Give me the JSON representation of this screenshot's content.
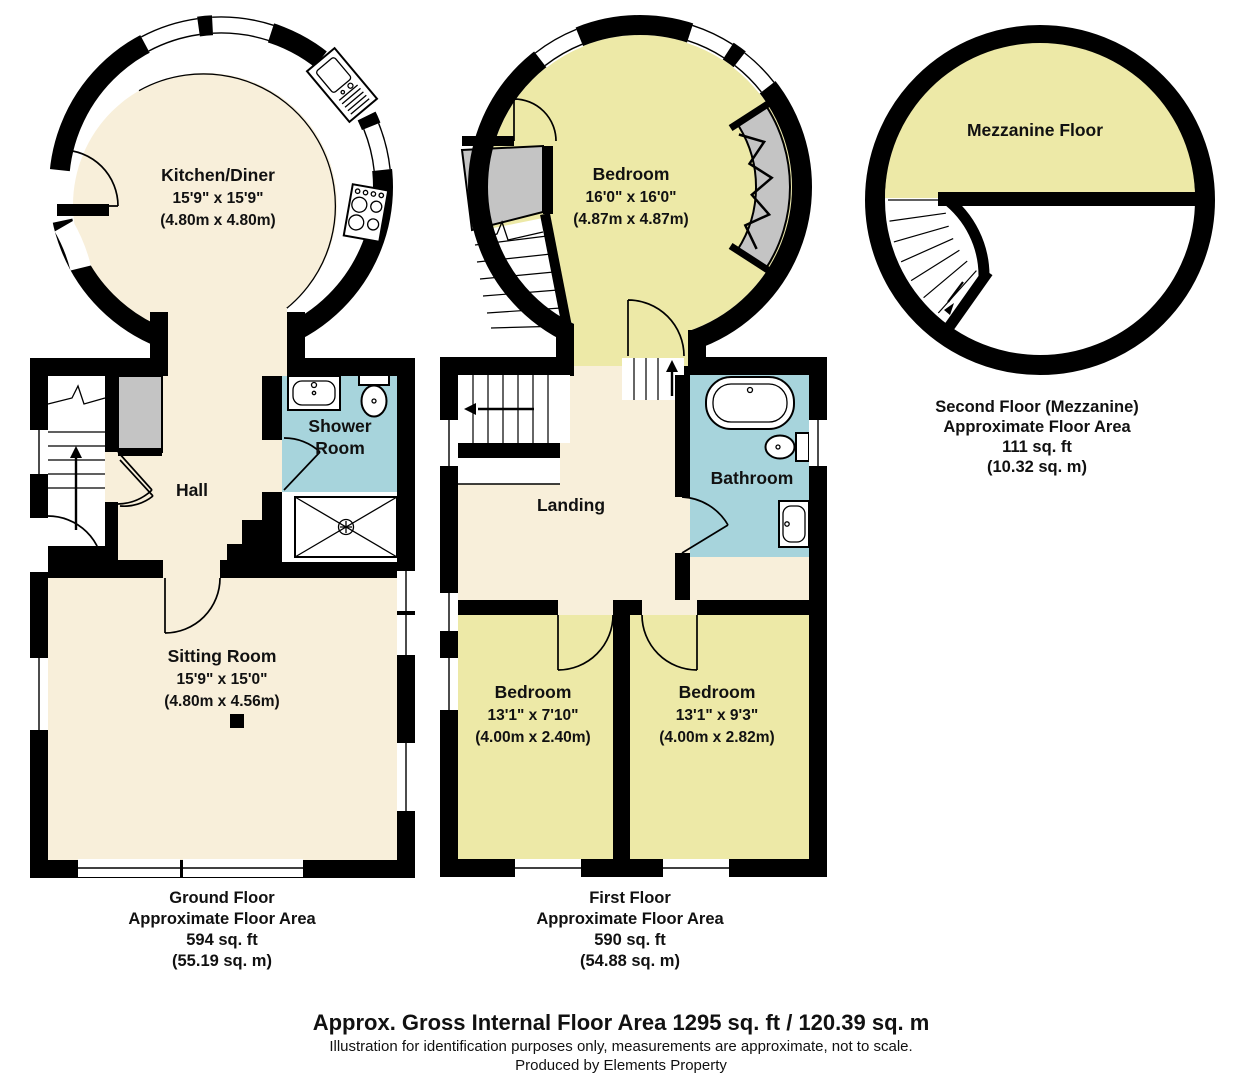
{
  "colors": {
    "room_cream": "#F8EFDA",
    "room_yellow": "#EDE9A7",
    "room_blue": "#A7D4DC",
    "cupboard_gray": "#C4C4C4",
    "wall_black": "#000000"
  },
  "ground_floor": {
    "kitchen": {
      "name": "Kitchen/Diner",
      "dims_imperial": "15'9\" x 15'9\"",
      "dims_metric": "(4.80m x 4.80m)"
    },
    "hall": {
      "name": "Hall"
    },
    "shower_room": {
      "name_line1": "Shower",
      "name_line2": "Room"
    },
    "sitting_room": {
      "name": "Sitting Room",
      "dims_imperial": "15'9\" x 15'0\"",
      "dims_metric": "(4.80m x 4.56m)"
    },
    "caption": {
      "line1": "Ground Floor",
      "line2": "Approximate Floor Area",
      "line3": "594 sq. ft",
      "line4": "(55.19 sq. m)"
    }
  },
  "first_floor": {
    "bedroom_main": {
      "name": "Bedroom",
      "dims_imperial": "16'0\" x 16'0\"",
      "dims_metric": "(4.87m x 4.87m)"
    },
    "landing": {
      "name": "Landing"
    },
    "bathroom": {
      "name": "Bathroom"
    },
    "bedroom_left": {
      "name": "Bedroom",
      "dims_imperial": "13'1\" x 7'10\"",
      "dims_metric": "(4.00m x 2.40m)"
    },
    "bedroom_right": {
      "name": "Bedroom",
      "dims_imperial": "13'1\" x 9'3\"",
      "dims_metric": "(4.00m x 2.82m)"
    },
    "caption": {
      "line1": "First Floor",
      "line2": "Approximate Floor Area",
      "line3": "590 sq. ft",
      "line4": "(54.88 sq. m)"
    }
  },
  "second_floor": {
    "mezzanine": {
      "name": "Mezzanine Floor"
    },
    "caption": {
      "line1": "Second Floor (Mezzanine)",
      "line2": "Approximate Floor Area",
      "line3": "111 sq. ft",
      "line4": "(10.32 sq. m)"
    }
  },
  "footer": {
    "title": "Approx. Gross Internal Floor Area 1295 sq. ft / 120.39 sq. m",
    "disclaimer": "Illustration for identification purposes only, measurements are approximate, not to scale.",
    "credit": "Produced by Elements Property"
  }
}
